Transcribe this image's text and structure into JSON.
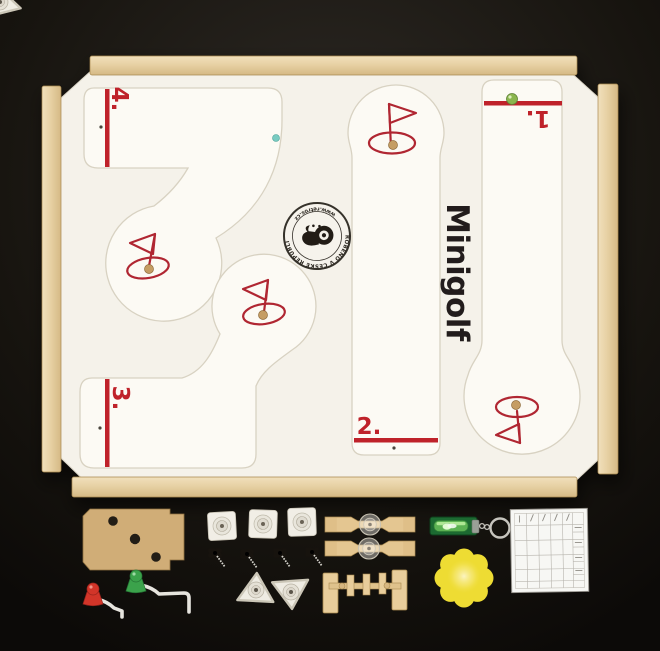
{
  "board": {
    "title": "Minigolf",
    "holes": [
      "4.",
      "3.",
      "2.",
      "1."
    ],
    "stamp": {
      "arc_top": "VYROBENO V ČESKÉ REPUBLICE",
      "arc_bottom": "www.retros.cz"
    }
  },
  "colors": {
    "background": "#1a1713",
    "accent_red": "#bf2229",
    "board_surface": "#f5f2ea",
    "lane_surface": "#fcfaf4",
    "wood_rail": "#e6cfa0",
    "title_black": "#211f1b",
    "mdf_tan": "#d0ad77",
    "putter_red": "#d23529",
    "putter_green": "#3ba24b",
    "ball_green": "#8ab54d",
    "ball_teal": "#79cbc1",
    "level_green": "#1c6a31",
    "sponge_yellow": "#eedc33"
  },
  "accessories": {
    "items": [
      {
        "name": "mdf-target-board",
        "count": 1
      },
      {
        "name": "square-foot-tile",
        "count": 3
      },
      {
        "name": "wing-screw",
        "count": 4
      },
      {
        "name": "spinner-obstacle",
        "count": 2
      },
      {
        "name": "level-keychain",
        "count": 1
      },
      {
        "name": "scorecard",
        "count": 1
      },
      {
        "name": "putter",
        "count": 2
      },
      {
        "name": "triangle-obstacle",
        "count": 3
      },
      {
        "name": "gate-obstacle",
        "count": 1
      },
      {
        "name": "flower-sponge",
        "count": 1
      }
    ]
  }
}
